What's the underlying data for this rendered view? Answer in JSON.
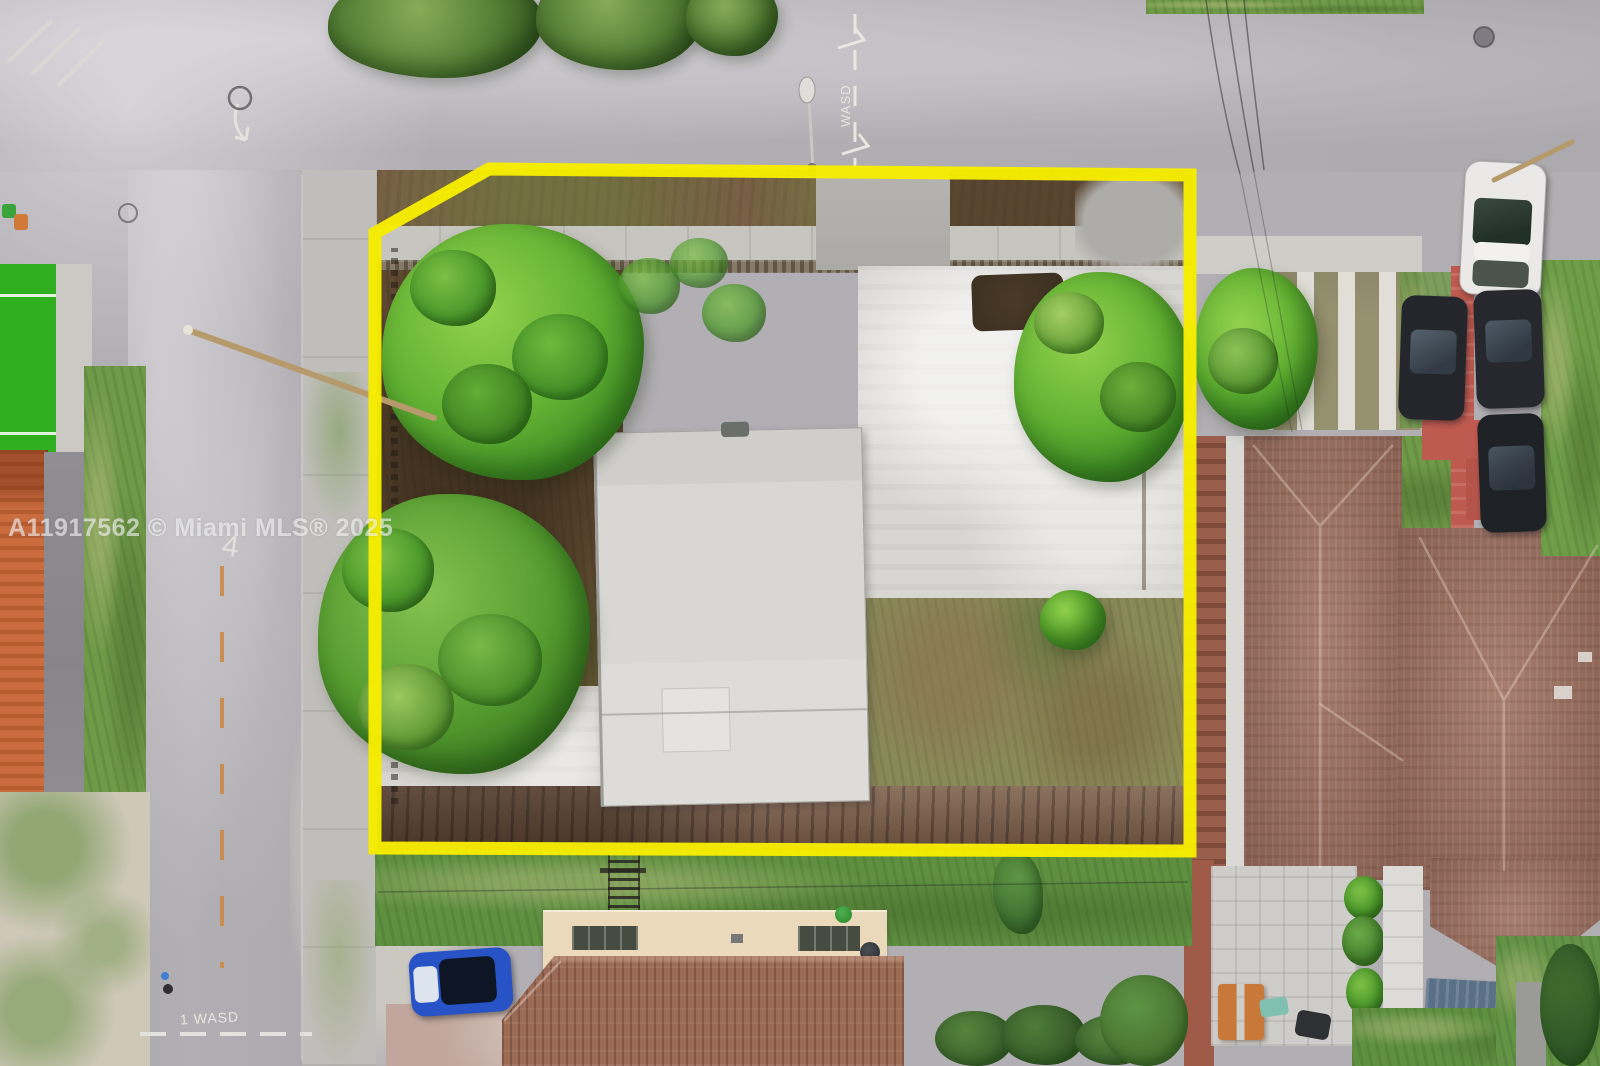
{
  "scene": {
    "kind": "aerial-drone-photo",
    "subject": "Vacant residential corner lot with yellow property boundary overlay",
    "watermark": "A11917562 © Miami MLS® 2025"
  },
  "road_markings": {
    "top_center_line_label": "WASD",
    "bottom_stop_line_label": "1 WASD",
    "left_road_survey_mark": "4"
  },
  "boundary": {
    "color": "#f6ec00",
    "shape": "parcel outline: rectangle with clipped top-left corner"
  },
  "colors": {
    "road": "#b1afb3",
    "sidewalk": "#c0beba",
    "lot_dirt": "#6b563c",
    "grass": "#6f9a48",
    "turf_field": "#2fae1f",
    "tree_green": "#5cab31",
    "house_roof": "#d7d6d2",
    "neighbor_roof": "#9b7162",
    "bottom_roof": "#9c6b55",
    "flat_roof_tan": "#ead9ba",
    "red_walkway": "#bf5a50",
    "orange_structure": "#ca6c3e",
    "boundary_yellow": "#f6ec00",
    "watermark": "rgba(255,255,255,0.58)"
  }
}
